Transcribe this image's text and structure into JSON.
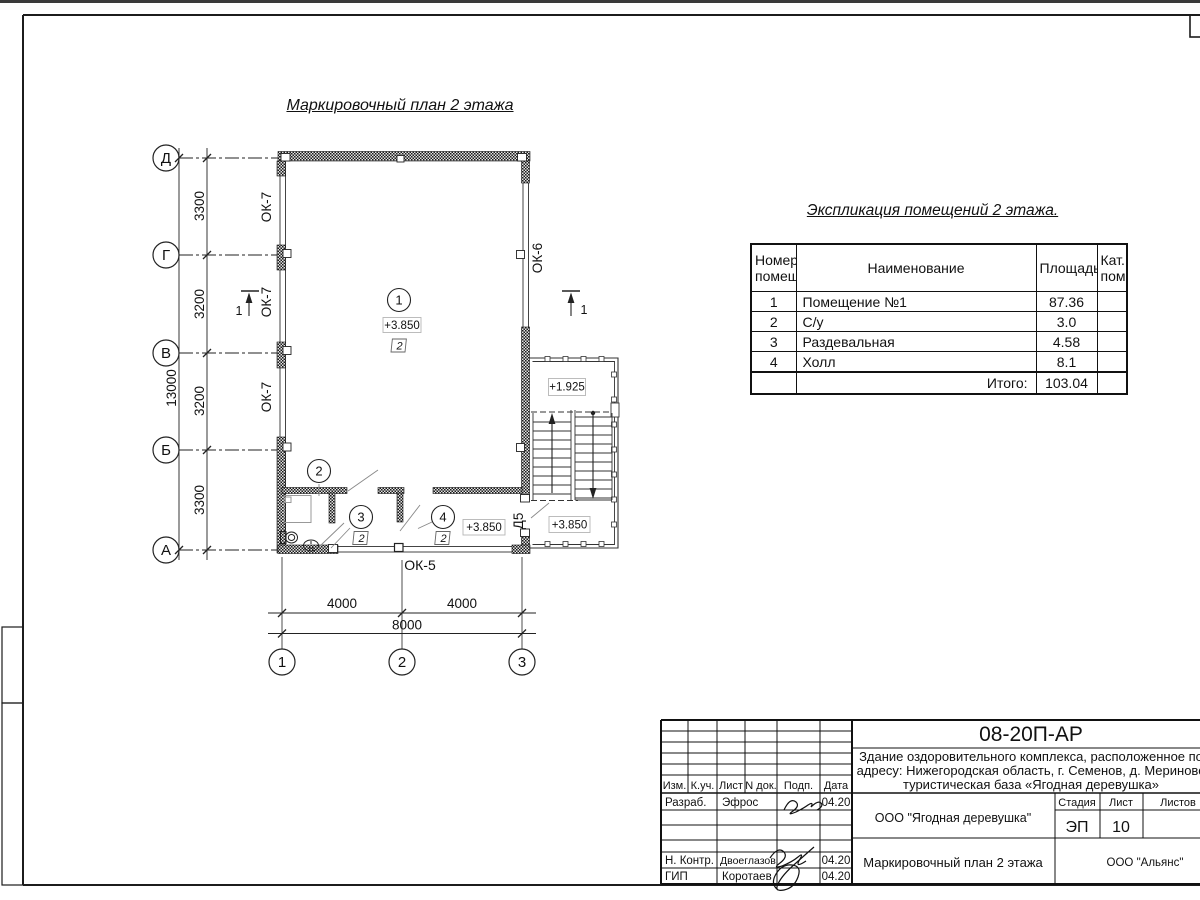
{
  "sheet": {
    "plan_title": "Маркировочный план 2 этажа",
    "axes": {
      "left": [
        "Д",
        "Г",
        "В",
        "Б",
        "А"
      ],
      "bottom": [
        "1",
        "2",
        "3"
      ]
    },
    "dimensions": {
      "left_segments": [
        "3300",
        "3200",
        "3200",
        "3300"
      ],
      "left_total": "13000",
      "bottom_segments": [
        "4000",
        "4000"
      ],
      "bottom_total": "8000"
    },
    "marks": {
      "ok7": "ОК-7",
      "ok6": "ОК-6",
      "ok5": "ОК-5",
      "d5": "Д5",
      "section": "1",
      "room1": "1",
      "room2": "2",
      "room3": "3",
      "room4": "4",
      "cat2": "2",
      "elev_main": "+3.850",
      "elev_landing": "+1.925"
    }
  },
  "explication": {
    "title": "Экспликация помещений 2 этажа.",
    "col_num": "Номер помещ.",
    "col_name": "Наименование",
    "col_area": "Площадь",
    "col_cat": "Кат. пом.",
    "rows": [
      {
        "num": "1",
        "name": "Помещение №1",
        "area": "87.36",
        "cat": ""
      },
      {
        "num": "2",
        "name": "С/у",
        "area": "3.0",
        "cat": ""
      },
      {
        "num": "3",
        "name": "Раздевальная",
        "area": "4.58",
        "cat": ""
      },
      {
        "num": "4",
        "name": "Холл",
        "area": "8.1",
        "cat": ""
      }
    ],
    "total_label": "Итого:",
    "total_area": "103.04"
  },
  "titleblock": {
    "doc_number": "08-20П-АР",
    "description": {
      "line1": "Здание оздоровительного комплекса, расположенное по",
      "line2": "адресу: Нижегородская область, г. Семенов, д. Мериново",
      "line3": "туристическая база «Ягодная деревушка»"
    },
    "org": "ООО \"Ягодная деревушка\"",
    "company": "ООО \"Альянс\"",
    "drawing_title": "Маркировочный план 2 этажа",
    "stage_label": "Стадия",
    "sheet_label": "Лист",
    "sheets_label": "Листов",
    "stage": "ЭП",
    "sheet_num": "10",
    "cols": {
      "izm": "Изм.",
      "kuch": "К.уч.",
      "list": "Лист",
      "ndok": "N док.",
      "podp": "Подп.",
      "data": "Дата"
    },
    "rows": {
      "developer_label": "Разраб.",
      "developer": "Эфрос",
      "developer_date": "04.20",
      "ncontrol_label": "Н. Контр.",
      "ncontrol": "Двоеглазов",
      "ncontrol_date": "04.20",
      "gip_label": "ГИП",
      "gip": "Коротаев",
      "gip_date": "04.20"
    }
  }
}
